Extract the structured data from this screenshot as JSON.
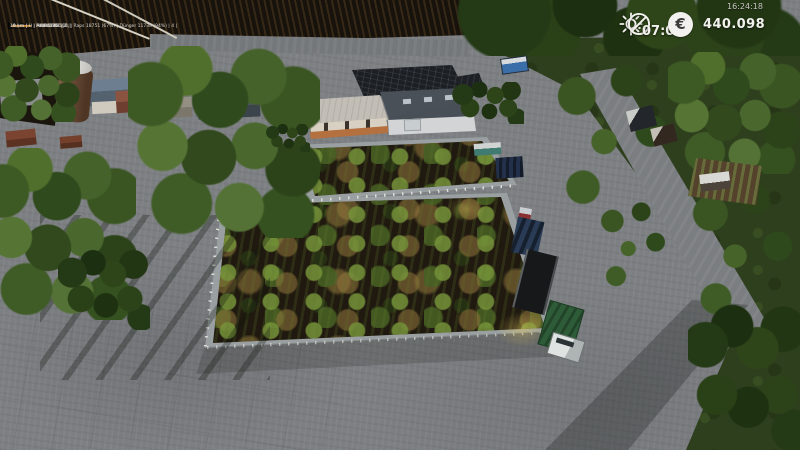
{
  "meta": {
    "title": "Farming Simulator 19 aerial farm view"
  },
  "hud": {
    "system_clock": "16:24:18",
    "game_time": "07:06",
    "currency_symbol": "€",
    "money": "440.098",
    "weather_icon": "sun-icon",
    "time_icon": "clock-icon",
    "text_color": "#f2f1ee"
  },
  "vehicle_list": {
    "entries": [
      {
        "text": "13 km | H | Arion 500. | 2 |"
      },
      {
        "text": "20 km | H | AXION 960 |",
        "suffix": "| 1 |"
      },
      {
        "text": "10 km | H | HORIZON 500. | Raps 18751 (67%) | Dünger 11738 (94%) | 4 |"
      },
      {
        "text": "10 km | H | Fastrac 83. | 1 |"
      }
    ],
    "bar_color": "#c08840"
  },
  "scene": {
    "colors": {
      "pavement": "#7d8083",
      "grass": "#2e3f1d",
      "plowed_soil": "#17120b",
      "field_soil": "#20190f",
      "fence": "#9aa0a2",
      "warehouse_roof_dark": "#40454c",
      "warehouse_roof_light": "#b3b0a8",
      "wall_cream": "#d8d0c2",
      "accent_orange": "#b4703f",
      "silo_brown": "#6e4c34",
      "trailer_green": "#2e5c38",
      "truck_white": "#dfe3e2",
      "planter_blue": "#2a3c55"
    }
  }
}
